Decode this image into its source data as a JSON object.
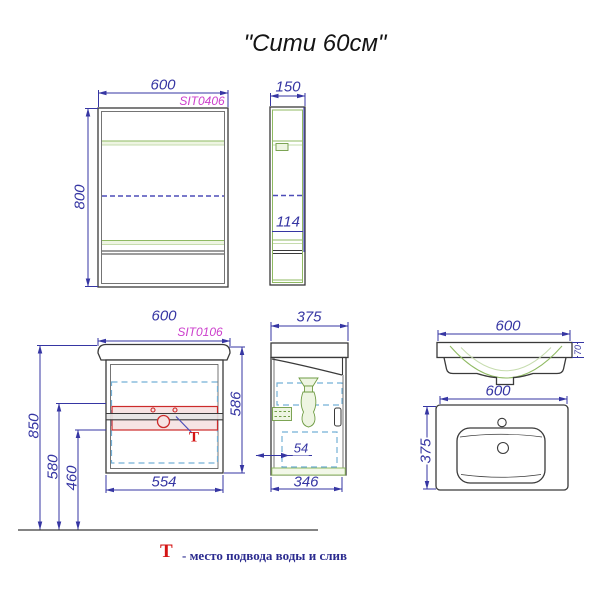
{
  "title": "\"Сити 60см\"",
  "mirror_cabinet": {
    "code": "SIT0406",
    "width": "600",
    "height": "800",
    "depth": "150",
    "shelf_dim": "114"
  },
  "vanity": {
    "code": "SIT0106",
    "width": "600",
    "total_height": "850",
    "supply_height": "580",
    "drain_height": "460",
    "inner_width": "554",
    "body_height": "586",
    "depth": "375",
    "door_offset": "54",
    "body_depth": "346"
  },
  "sink": {
    "front_width": "600",
    "rim_height": "70",
    "top_width": "600",
    "top_depth": "375"
  },
  "marker": {
    "symbol": "Т"
  },
  "legend": {
    "symbol": "Т",
    "text": "- место подвода воды и слив"
  },
  "colors": {
    "dimension": "#3636a3",
    "code_label": "#cc3fcc",
    "shelf_green": "#8fba62",
    "door_dash": "#74b0d6",
    "mirror_dash": "#4d4db8",
    "supply_red": "#cc2a2a",
    "outline": "#3a3a3a",
    "legend_text": "#2b2b8f"
  }
}
